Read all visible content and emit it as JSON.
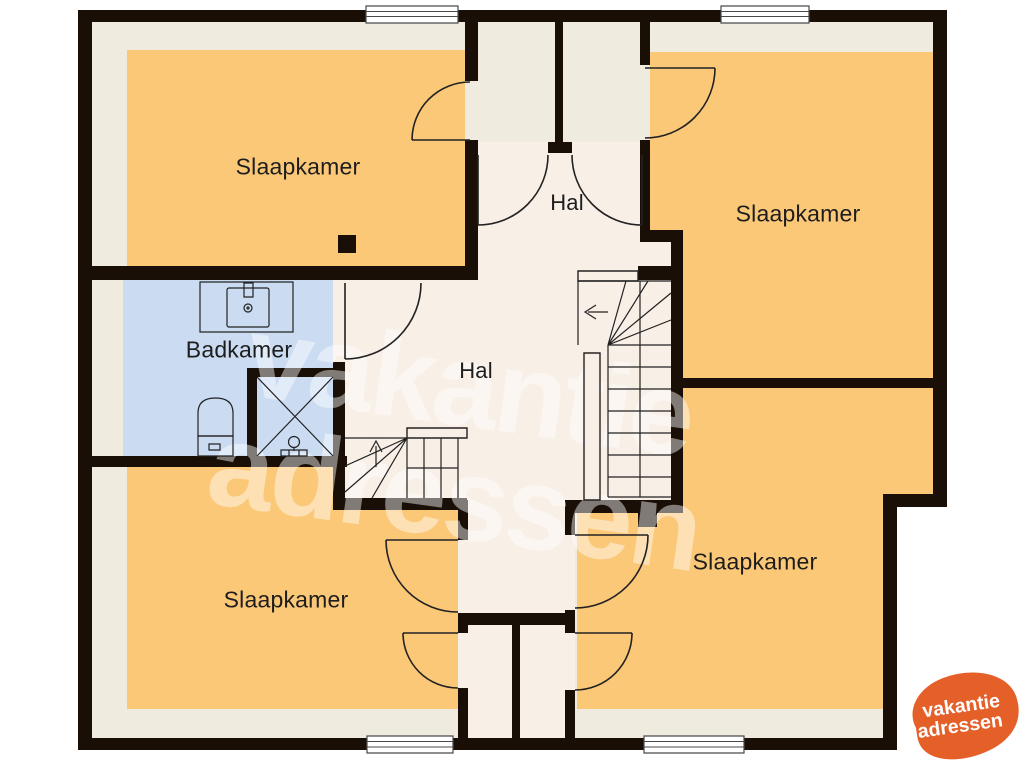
{
  "floorplan": {
    "rooms": [
      {
        "id": "bedroom-top-left",
        "label": "Slaapkamer"
      },
      {
        "id": "bedroom-top-right",
        "label": "Slaapkamer"
      },
      {
        "id": "bedroom-bottom-left",
        "label": "Slaapkamer"
      },
      {
        "id": "bedroom-bottom-right",
        "label": "Slaapkamer"
      },
      {
        "id": "bathroom",
        "label": "Badkamer"
      },
      {
        "id": "hall-top",
        "label": "Hal"
      },
      {
        "id": "hall-main",
        "label": "Hal"
      }
    ],
    "watermark": {
      "line1": "vakantie",
      "line2": "adressen"
    },
    "logo": {
      "line1": "vakantie",
      "line2": "adressen"
    },
    "icons": [
      "stairs-icon",
      "door-swing-icon",
      "window-icon",
      "toilet-icon",
      "shower-icon",
      "washbasin-icon"
    ],
    "colors": {
      "background": "#ffffff",
      "wall": "#190f06",
      "floor_bedroom": "#fbc878",
      "floor_bathroom": "#cbdcf2",
      "floor_hall": "#f8efe7",
      "floor_margin": "#f0ebdf",
      "logo_orange": "#e55f28",
      "watermark_white": "rgba(255,255,255,0.45)"
    }
  }
}
